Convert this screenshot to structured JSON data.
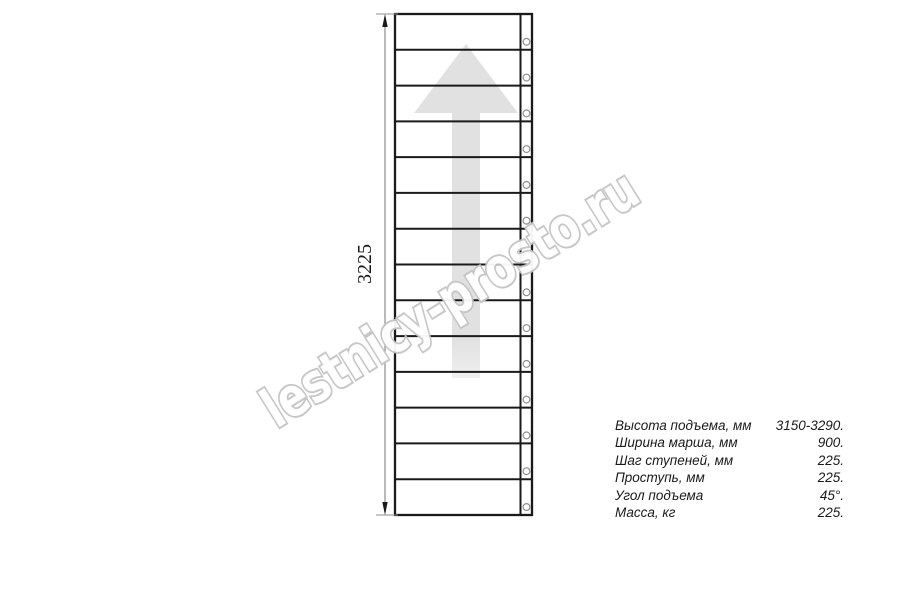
{
  "drawing": {
    "dimension_label": "3225",
    "steps_count": 14,
    "geometry": {
      "left": 395,
      "top": 14,
      "right": 532,
      "bottom": 515,
      "stringer_divider_x": 520.5,
      "hole_cx": 526.5,
      "hole_r": 3.4,
      "hole_offset_above_line": 8,
      "dim_line_x": 385
    },
    "colors": {
      "line": "#1a1a1a",
      "dim_line": "#8c8c8c",
      "arrow_fill": "#e1e1e1",
      "arrow_fill_fade": "#efefef",
      "hole_stroke": "#8f8f8f",
      "watermark_stroke": "#c5c5c5",
      "watermark_fill": "#ffffff",
      "text": "#1a1a1a"
    }
  },
  "watermark": {
    "text": "lestnicy-prosto.ru"
  },
  "specs": {
    "rows": [
      {
        "label": "Высота подъема, мм",
        "value": "3150-3290."
      },
      {
        "label": "Ширина марша, мм",
        "value": "900."
      },
      {
        "label": "Шаг ступеней, мм",
        "value": "225."
      },
      {
        "label": "Проступь, мм",
        "value": "225."
      },
      {
        "label": "Угол подъема",
        "value": "45°."
      },
      {
        "label": "Масса, кг",
        "value": "225."
      }
    ]
  }
}
